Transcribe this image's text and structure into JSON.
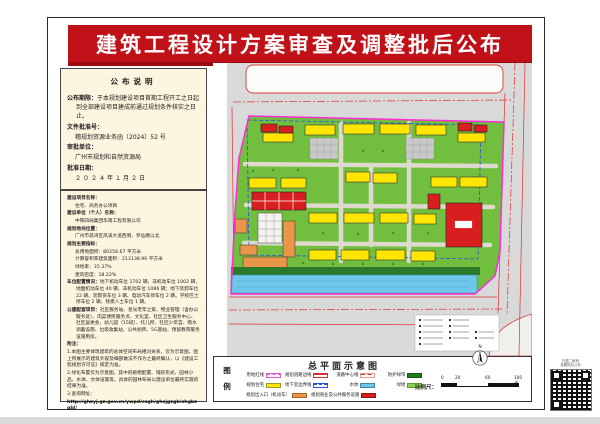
{
  "banner": {
    "title": "建筑工程设计方案审查及调整批后公布"
  },
  "notice": {
    "header": "公布说明",
    "period_label": "公布期限：",
    "period_value": "于本规划建设项目首期工程开工之日起到全部建设项目建成前通过规划条件核实之日止。",
    "doc_no_label": "文件批准号：",
    "doc_no_value": "穗规划资源业务函〔2024〕52 号",
    "authority_label": "审批单位：",
    "authority_value": "广州市规划和自然资源局",
    "date_label": "批准日期：",
    "date_value": "２０２４年１月２日"
  },
  "project": {
    "fields": [
      {
        "label": "建设项目名称：",
        "value": "住宅、商务办公项目"
      },
      {
        "label": "建设单位（个人）名称：",
        "value": "中铁四局集团华南工程有限公司"
      },
      {
        "label": "规划地块位置：",
        "value": "广州市荔湾区凤溪大道西侧、罗仙路以北"
      }
    ],
    "indicators_label": "规划主要指标：",
    "indicators": [
      {
        "label": "总用地面积：",
        "value": "80256.67 平方米"
      },
      {
        "label": "计算容积率建筑面积：",
        "value": "213138.96 平方米"
      },
      {
        "label": "绿地率：",
        "value": "35.37%"
      },
      {
        "label": "建筑密度：",
        "value": "18.22%"
      }
    ],
    "parking_label": "车位配置情况：",
    "parking_value": "地下机动车位 1702 辆、非机动车位 1002 辆，地面机动车位 40 辆、非机动车位 1086 辆；地下装卸车位 22 辆、装卸货车位 3 辆、电动汽车停车位 2 辆、学校巴士停车位 2 辆、残疾人士车位 1 辆。",
    "amenities_label": "公建配套项目：",
    "amenities_value": "社区服务站、星光老年之家、物业管理（含办公服务处）、肉菜便民服务点、文化室、社区卫生服务中心、社区居委会、幼儿园（15班）、托儿所、社区少年宫、雨水调蓄设施、垃圾收集站、公共厕所、5G基站、预留教育服务设施用房。",
    "notes_label": "附注：",
    "notes": [
      "1.本图主要体现建筑的总体空间布局相对关系，仅为示意图，图上所展示的建筑外观及细部做法不作为之最终确认，以《建设工程规划许可证》核定为准。",
      "2.绿化布置仅为示意图，其中的植物配置、铺装形式、园林小品、水体、文体设施等，具体的园林布局以建设单位最终实施的结果为准。",
      "3.查询网址："
    ],
    "url": "http://ghzyj.gz.gov.cn/ywpd/csgh/ghsjgzgb/shgbzgbl/"
  },
  "legend": {
    "panel_title": "总平面示意图",
    "legend_char_1": "图",
    "legend_char_2": "例",
    "rows": [
      [
        {
          "label": "用地红线",
          "swatch": "magenta-dash"
        },
        {
          "label": "规划道路边线",
          "swatch": "red-lines"
        },
        {
          "label": "道路中心线",
          "swatch": "pink-dash"
        },
        {
          "label": "防护绿带",
          "swatch": "dark-green"
        }
      ],
      [
        {
          "label": "规划住宅",
          "swatch": "yellow"
        },
        {
          "label": "地下室边界线",
          "swatch": "blue-dash"
        },
        {
          "label": "水体",
          "swatch": "water"
        },
        {
          "label": "绿地",
          "swatch": "light-green"
        }
      ],
      [
        {
          "label": "规划出入口（机动车）",
          "swatch": "orange"
        },
        {
          "label": "规划商业及公共服务设施",
          "swatch": "red"
        }
      ]
    ],
    "scale_label": "比例尺：",
    "scale_ticks": [
      "0",
      "20",
      "60",
      "100米"
    ],
    "north_label": "N"
  },
  "qr": {
    "caption_line1": "扫描二维码",
    "caption_line2": "查看批后公布"
  },
  "colors": {
    "banner_red": "#c01118",
    "sidebar_cream": "#fdf5e0",
    "map_gray": "#d9d9d9",
    "site_green": "#72bf3f",
    "water_blue": "#6cc7e8",
    "building_yellow": "#ffe500",
    "building_red": "#d81e1e",
    "building_orange": "#e9964b",
    "boundary_magenta": "#ff2bd6"
  }
}
